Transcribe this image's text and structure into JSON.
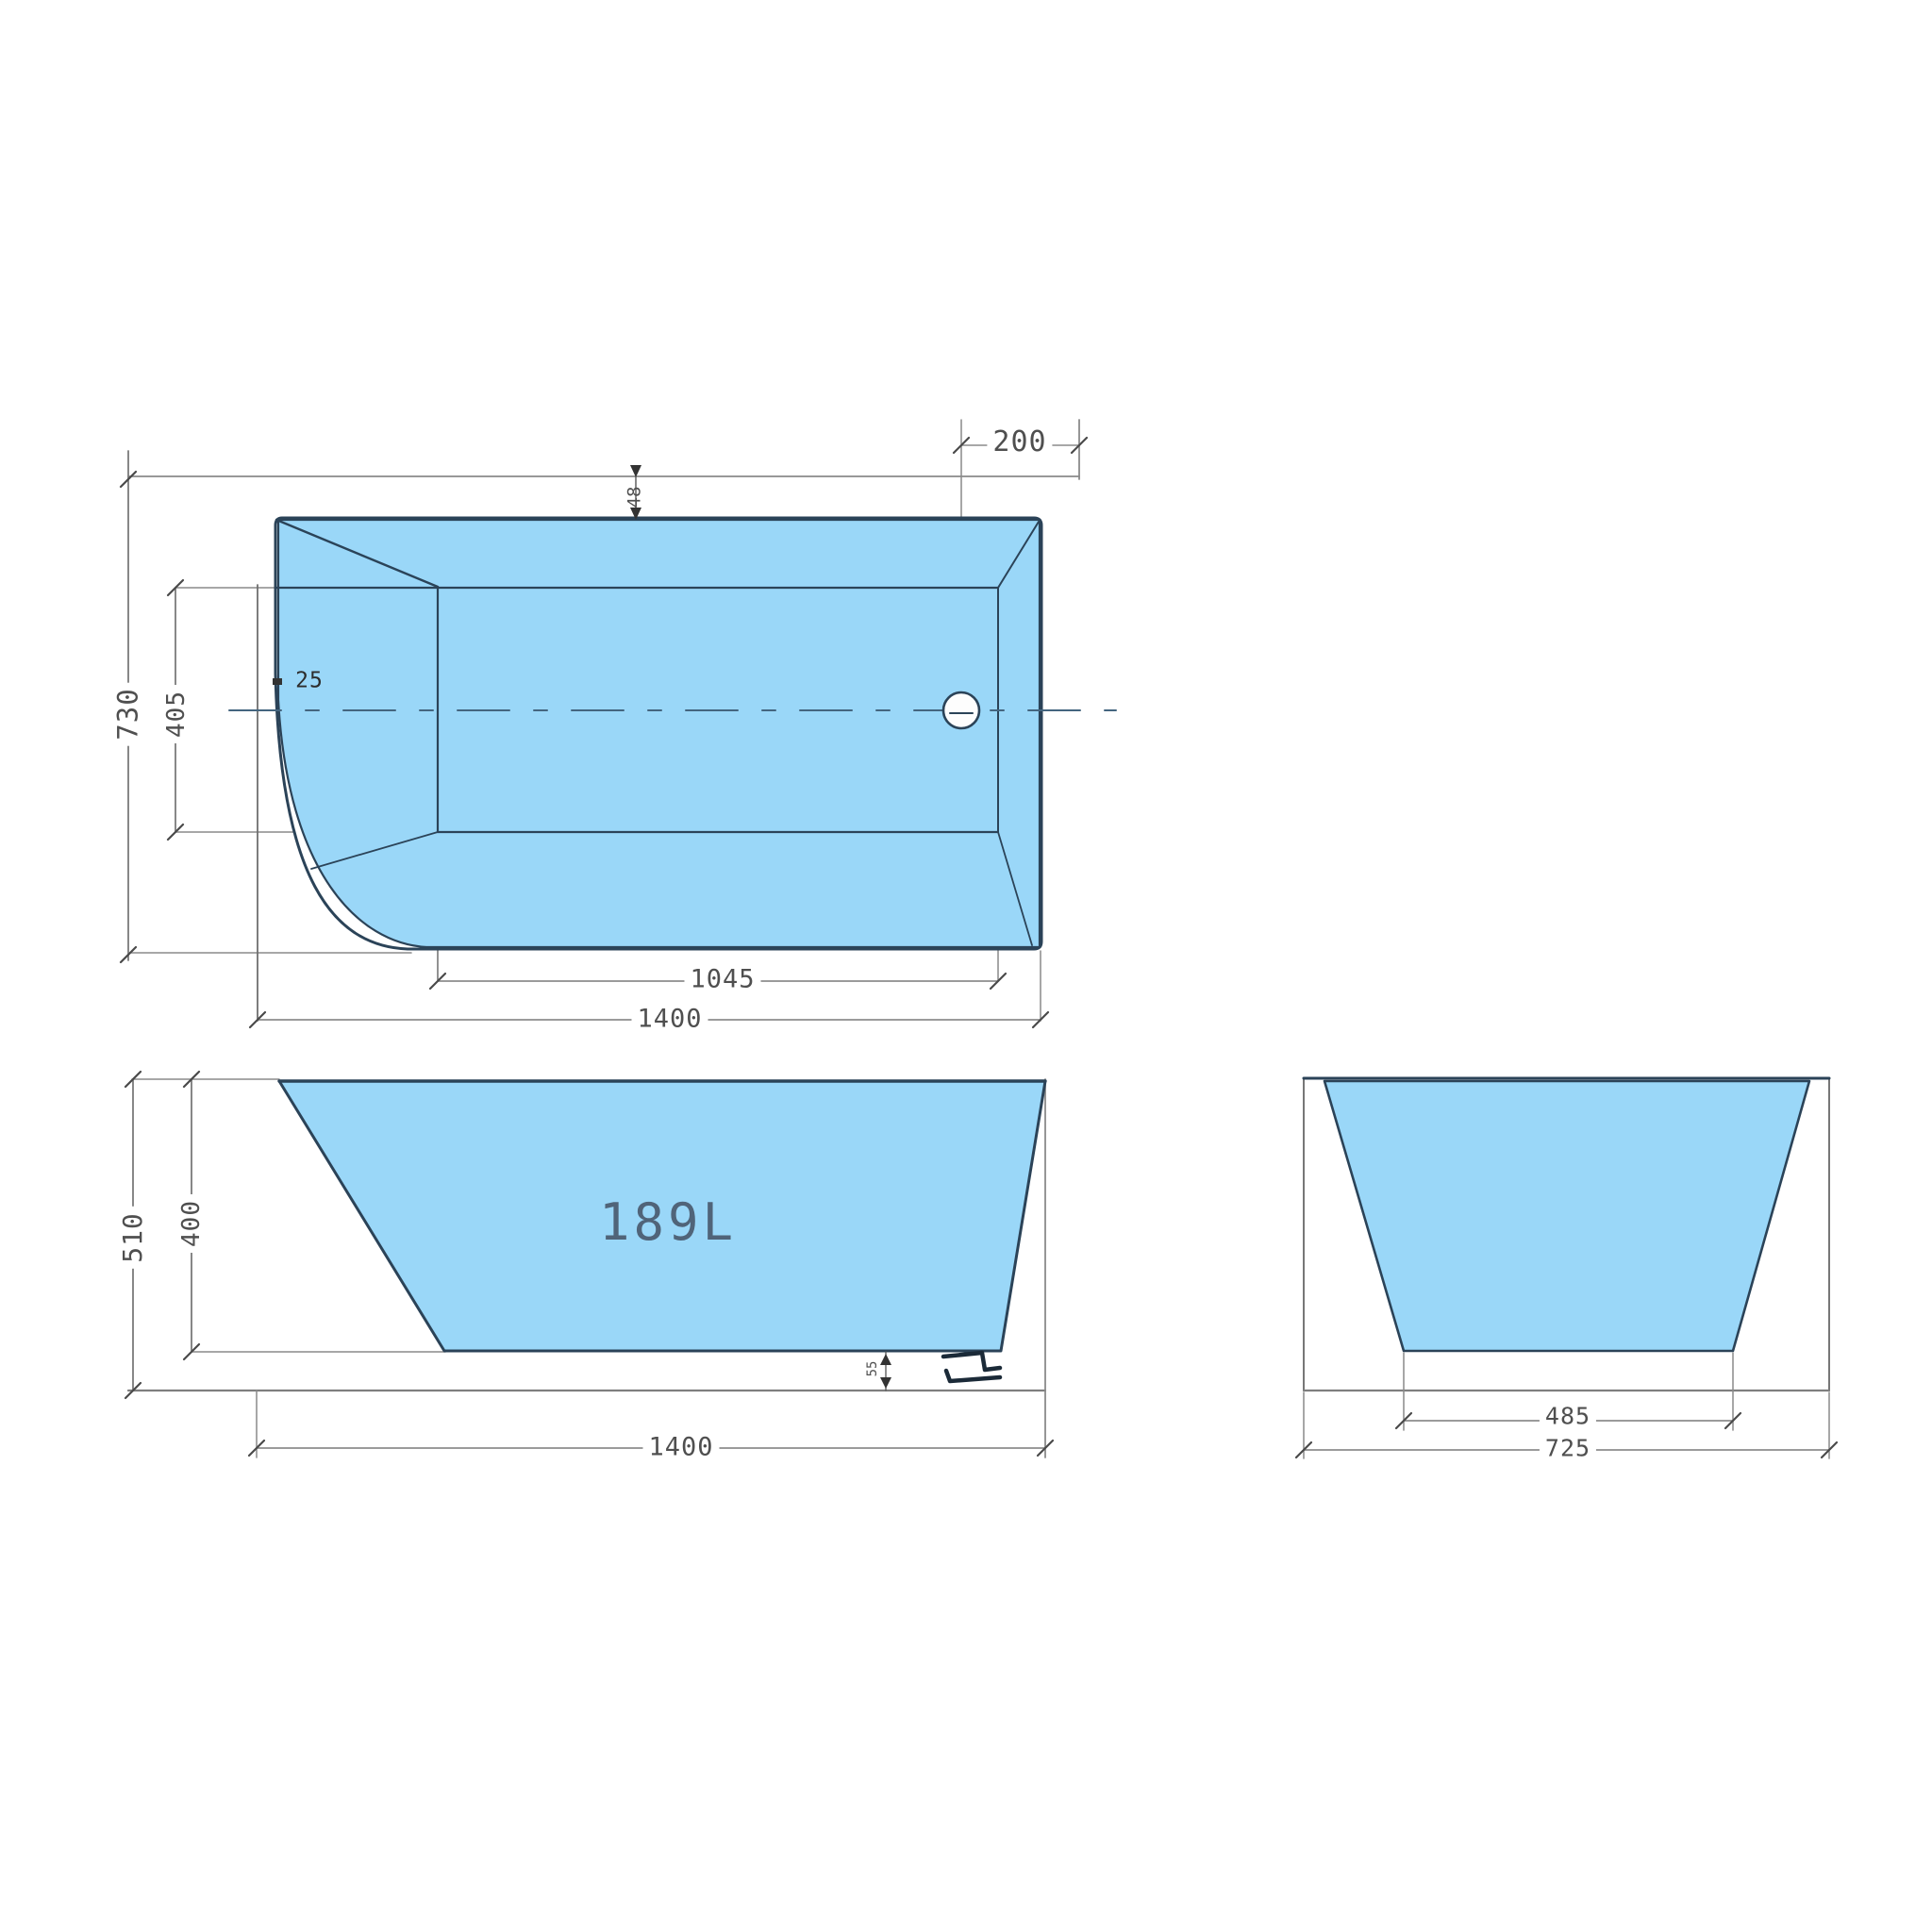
{
  "drawing": {
    "kind": "bathtub-dimension-drawing",
    "colors": {
      "tub_fill": "#9ad7f8",
      "outline": "#2b4358",
      "dimension_line": "#8a8a8a",
      "label_text": "#4f4f4f",
      "background": "#ffffff"
    },
    "views": {
      "top": {
        "name": "top-view",
        "dims": {
          "drain_offset": "200",
          "rim_front": "48",
          "overall_width": "730",
          "inner_width": "405",
          "rim_side": "25",
          "floor_length": "1045",
          "overall_length": "1400"
        }
      },
      "front": {
        "name": "front-view",
        "volume": "189L",
        "dims": {
          "overall_height": "510",
          "inner_depth": "400",
          "floor_clearance": "55",
          "overall_length": "1400"
        }
      },
      "side": {
        "name": "side-view",
        "dims": {
          "floor_width": "485",
          "overall_width": "725"
        }
      }
    }
  }
}
